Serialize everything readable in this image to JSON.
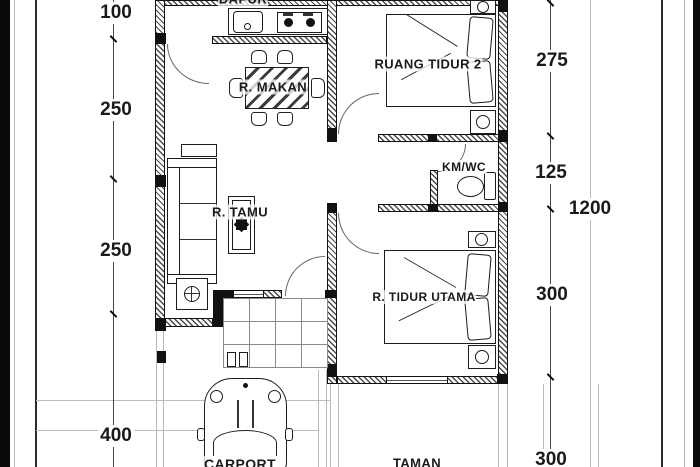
{
  "drawing": {
    "type": "house-floor-plan",
    "rooms": {
      "dapur": "DAPUR",
      "ruang_tidur_2": "RUANG TIDUR 2",
      "r_makan": "R. MAKAN",
      "km_wc": "KM/WC",
      "r_tamu": "R. TAMU",
      "r_tidur_utama": "R. TIDUR UTAMA",
      "carport": "CARPORT",
      "taman": "TAMAN"
    },
    "dimensions": {
      "left": [
        {
          "value": "100"
        },
        {
          "value": "250"
        },
        {
          "value": "250"
        },
        {
          "value": "400"
        }
      ],
      "right": [
        {
          "value": "275"
        },
        {
          "value": "125"
        },
        {
          "value": "1200"
        },
        {
          "value": "300"
        },
        {
          "value": "300"
        }
      ]
    },
    "colors": {
      "ink": "#1a1a1a",
      "wall_fill": "#111111",
      "construction_line": "#b9b9b9",
      "background": "#ffffff"
    }
  }
}
